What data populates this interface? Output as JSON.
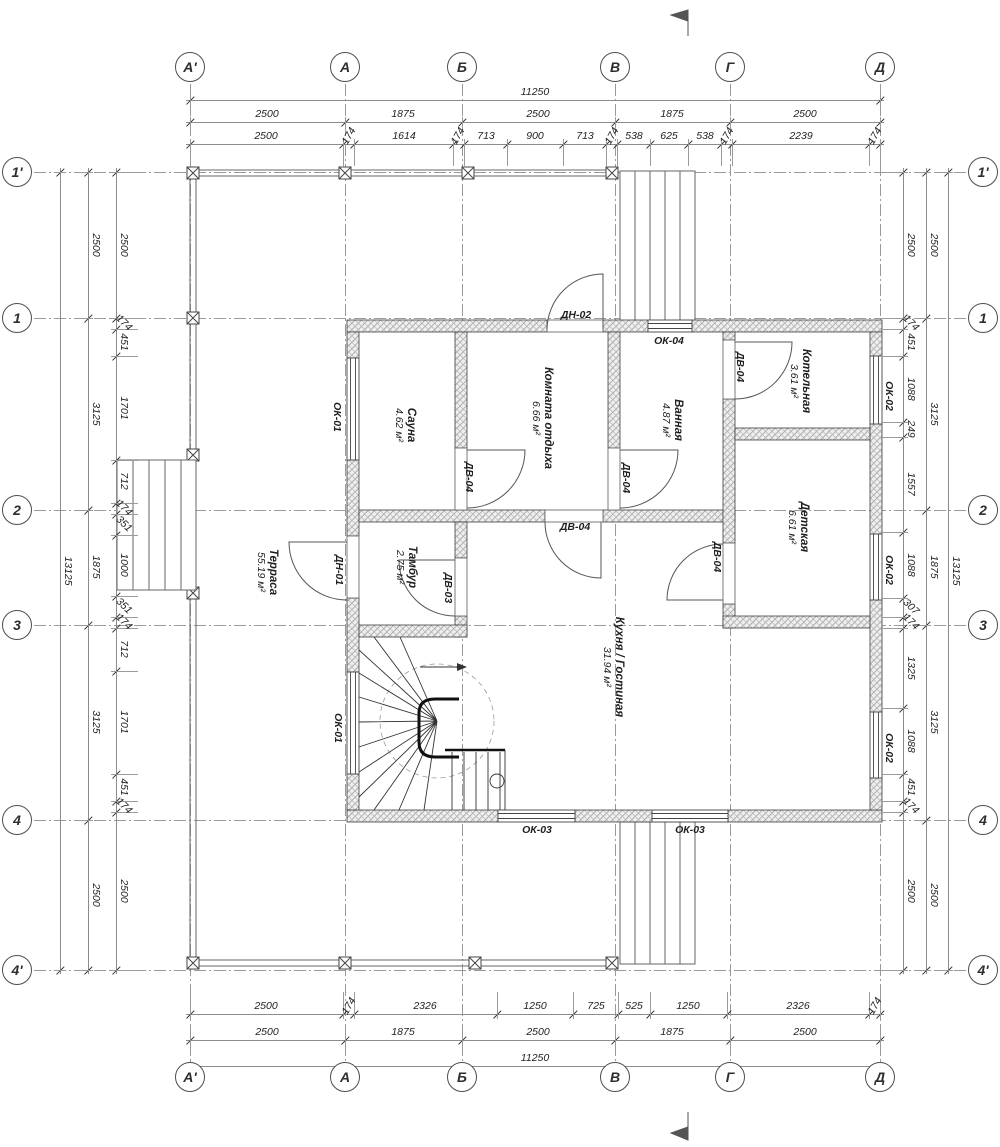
{
  "drawing": {
    "type": "floor-plan",
    "units": "mm",
    "total_width": "11250",
    "total_height": "13125",
    "line_color": "#3d3d3d",
    "hatch_color": "#8a8a8a"
  },
  "axes": {
    "vertical": [
      {
        "label": "А'",
        "x": 190
      },
      {
        "label": "А",
        "x": 345
      },
      {
        "label": "Б",
        "x": 462
      },
      {
        "label": "В",
        "x": 615
      },
      {
        "label": "Г",
        "x": 730
      },
      {
        "label": "Д",
        "x": 880
      }
    ],
    "horizontal": [
      {
        "label": "1'",
        "y": 172
      },
      {
        "label": "1",
        "y": 318
      },
      {
        "label": "2",
        "y": 510
      },
      {
        "label": "3",
        "y": 625
      },
      {
        "label": "4",
        "y": 820
      },
      {
        "label": "4'",
        "y": 970
      }
    ]
  },
  "dim_rows": [
    {
      "id": "top-total",
      "o": "h",
      "pos": 100,
      "from": 190,
      "to": 880,
      "ticks": [
        190,
        880
      ],
      "labels": [
        {
          "t": "11250",
          "c": 535
        }
      ]
    },
    {
      "id": "top-grid",
      "o": "h",
      "pos": 122,
      "from": 190,
      "to": 880,
      "ticks": [
        190,
        345,
        462,
        615,
        730,
        880
      ],
      "labels": [
        {
          "t": "2500",
          "c": 267
        },
        {
          "t": "1875",
          "c": 403
        },
        {
          "t": "2500",
          "c": 538
        },
        {
          "t": "1875",
          "c": 672
        },
        {
          "t": "2500",
          "c": 805
        }
      ]
    },
    {
      "id": "top-detail",
      "o": "h",
      "pos": 144,
      "from": 190,
      "to": 880,
      "ext": true,
      "extdir": 1,
      "ticks": [
        190,
        343,
        354,
        453,
        464,
        507,
        563,
        606,
        617,
        650,
        688,
        721,
        732,
        869,
        880
      ],
      "labels": [
        {
          "t": "2500",
          "c": 266
        },
        {
          "t": "174",
          "c": 349,
          "r": 1
        },
        {
          "t": "1614",
          "c": 404
        },
        {
          "t": "174",
          "c": 458,
          "r": 1
        },
        {
          "t": "713",
          "c": 486
        },
        {
          "t": "900",
          "c": 535
        },
        {
          "t": "713",
          "c": 585
        },
        {
          "t": "174",
          "c": 612,
          "r": 1
        },
        {
          "t": "538",
          "c": 634
        },
        {
          "t": "625",
          "c": 669
        },
        {
          "t": "538",
          "c": 705
        },
        {
          "t": "174",
          "c": 727,
          "r": 1
        },
        {
          "t": "2239",
          "c": 801
        },
        {
          "t": "174",
          "c": 875,
          "r": 1
        }
      ]
    },
    {
      "id": "bottom-detail",
      "o": "h",
      "pos": 1014,
      "from": 190,
      "to": 880,
      "ext": true,
      "extdir": -1,
      "ticks": [
        190,
        343,
        354,
        497,
        573,
        618,
        650,
        727,
        869,
        880
      ],
      "labels": [
        {
          "t": "2500",
          "c": 266
        },
        {
          "t": "174",
          "c": 349,
          "r": 1
        },
        {
          "t": "2326",
          "c": 425
        },
        {
          "t": "1250",
          "c": 535
        },
        {
          "t": "725",
          "c": 596
        },
        {
          "t": "525",
          "c": 634
        },
        {
          "t": "1250",
          "c": 688
        },
        {
          "t": "2326",
          "c": 798
        },
        {
          "t": "174",
          "c": 875,
          "r": 1
        }
      ]
    },
    {
      "id": "bottom-grid",
      "o": "h",
      "pos": 1040,
      "from": 190,
      "to": 880,
      "ticks": [
        190,
        345,
        462,
        615,
        730,
        880
      ],
      "labels": [
        {
          "t": "2500",
          "c": 267
        },
        {
          "t": "1875",
          "c": 403
        },
        {
          "t": "2500",
          "c": 538
        },
        {
          "t": "1875",
          "c": 672
        },
        {
          "t": "2500",
          "c": 805
        }
      ]
    },
    {
      "id": "bottom-total",
      "o": "h",
      "pos": 1066,
      "from": 190,
      "to": 880,
      "ticks": [
        190,
        880
      ],
      "labels": [
        {
          "t": "11250",
          "c": 535
        }
      ]
    },
    {
      "id": "left-total",
      "o": "v",
      "pos": 60,
      "from": 172,
      "to": 970,
      "ticks": [
        172,
        970
      ],
      "labels": [
        {
          "t": "13125",
          "c": 571
        }
      ]
    },
    {
      "id": "left-grid",
      "o": "v",
      "pos": 88,
      "from": 172,
      "to": 970,
      "ticks": [
        172,
        318,
        510,
        625,
        820,
        970
      ],
      "labels": [
        {
          "t": "2500",
          "c": 245
        },
        {
          "t": "3125",
          "c": 414
        },
        {
          "t": "1875",
          "c": 567
        },
        {
          "t": "3125",
          "c": 722
        },
        {
          "t": "2500",
          "c": 895
        }
      ]
    },
    {
      "id": "left-detail",
      "o": "v",
      "pos": 116,
      "from": 172,
      "to": 970,
      "ext": true,
      "extdir": 1,
      "ticks": [
        172,
        318,
        329,
        356,
        460,
        503,
        514,
        535,
        596,
        617,
        628,
        671,
        774,
        801,
        812,
        970
      ],
      "labels": [
        {
          "t": "2500",
          "c": 245
        },
        {
          "t": "174",
          "c": 323,
          "r": 1
        },
        {
          "t": "451",
          "c": 342
        },
        {
          "t": "1701",
          "c": 408
        },
        {
          "t": "712",
          "c": 481
        },
        {
          "t": "174",
          "c": 508,
          "r": 1
        },
        {
          "t": "351",
          "c": 524,
          "r": 1
        },
        {
          "t": "1000",
          "c": 565
        },
        {
          "t": "351",
          "c": 606,
          "r": 1
        },
        {
          "t": "174",
          "c": 622,
          "r": 1
        },
        {
          "t": "712",
          "c": 649
        },
        {
          "t": "1701",
          "c": 722
        },
        {
          "t": "451",
          "c": 787
        },
        {
          "t": "174",
          "c": 806,
          "r": 1
        },
        {
          "t": "2500",
          "c": 891
        }
      ]
    },
    {
      "id": "right-detail",
      "o": "v",
      "pos": 903,
      "from": 172,
      "to": 970,
      "ext": true,
      "extdir": -1,
      "ticks": [
        172,
        318,
        329,
        356,
        422,
        437,
        532,
        598,
        617,
        628,
        708,
        774,
        801,
        812,
        970
      ],
      "labels": [
        {
          "t": "2500",
          "c": 245
        },
        {
          "t": "174",
          "c": 323,
          "r": 1
        },
        {
          "t": "451",
          "c": 342
        },
        {
          "t": "1088",
          "c": 389
        },
        {
          "t": "249",
          "c": 429
        },
        {
          "t": "1557",
          "c": 484
        },
        {
          "t": "1088",
          "c": 565
        },
        {
          "t": "307",
          "c": 607,
          "r": 1
        },
        {
          "t": "174",
          "c": 622,
          "r": 1
        },
        {
          "t": "1325",
          "c": 668
        },
        {
          "t": "1088",
          "c": 741
        },
        {
          "t": "451",
          "c": 787
        },
        {
          "t": "174",
          "c": 806,
          "r": 1
        },
        {
          "t": "2500",
          "c": 891
        }
      ]
    },
    {
      "id": "right-grid",
      "o": "v",
      "pos": 926,
      "from": 172,
      "to": 970,
      "ticks": [
        172,
        318,
        510,
        625,
        820,
        970
      ],
      "labels": [
        {
          "t": "2500",
          "c": 245
        },
        {
          "t": "3125",
          "c": 414
        },
        {
          "t": "1875",
          "c": 567
        },
        {
          "t": "3125",
          "c": 722
        },
        {
          "t": "2500",
          "c": 895
        }
      ]
    },
    {
      "id": "right-total",
      "o": "v",
      "pos": 948,
      "from": 172,
      "to": 970,
      "ticks": [
        172,
        970
      ],
      "labels": [
        {
          "t": "13125",
          "c": 571
        }
      ]
    }
  ],
  "rooms": [
    {
      "name": "Сауна",
      "area": "4.62 м²",
      "x": 405,
      "y": 425,
      "rot": true
    },
    {
      "name": "Комната отдыха",
      "area": "6.66 м²",
      "x": 542,
      "y": 418,
      "rot": true
    },
    {
      "name": "Ванная",
      "area": "4.87 м²",
      "x": 672,
      "y": 420,
      "rot": true
    },
    {
      "name": "Котельная",
      "area": "3.61 м²",
      "x": 800,
      "y": 381,
      "rot": true
    },
    {
      "name": "Детская",
      "area": "6.61 м²",
      "x": 798,
      "y": 527,
      "rot": true
    },
    {
      "name": "Кухня / Гостиная",
      "area": "31.94 м²",
      "x": 613,
      "y": 667,
      "rot": true
    },
    {
      "name": "Тамбур",
      "area": "2.75 м²",
      "x": 406,
      "y": 567,
      "rot": true
    },
    {
      "name": "Терраса",
      "area": "55.19 м²",
      "x": 267,
      "y": 572,
      "rot": true
    }
  ],
  "opening_tags": [
    {
      "t": "ДН-02",
      "x": 576,
      "y": 315,
      "rot": false
    },
    {
      "t": "ОК-04",
      "x": 669,
      "y": 341,
      "rot": false
    },
    {
      "t": "ДВ-04",
      "x": 469,
      "y": 477,
      "rot": true
    },
    {
      "t": "ДВ-04",
      "x": 626,
      "y": 478,
      "rot": true
    },
    {
      "t": "ДВ-04",
      "x": 740,
      "y": 367,
      "rot": true
    },
    {
      "t": "ДВ-04",
      "x": 575,
      "y": 527,
      "rot": false
    },
    {
      "t": "ДВ-04",
      "x": 717,
      "y": 557,
      "rot": true
    },
    {
      "t": "ДВ-03",
      "x": 448,
      "y": 588,
      "rot": true
    },
    {
      "t": "ДН-01",
      "x": 339,
      "y": 570,
      "rot": true
    },
    {
      "t": "ОК-01",
      "x": 337,
      "y": 417,
      "rot": true
    },
    {
      "t": "ОК-01",
      "x": 338,
      "y": 728,
      "rot": true
    },
    {
      "t": "ОК-02",
      "x": 889,
      "y": 396,
      "rot": true
    },
    {
      "t": "ОК-02",
      "x": 889,
      "y": 570,
      "rot": true
    },
    {
      "t": "ОК-02",
      "x": 889,
      "y": 748,
      "rot": true
    },
    {
      "t": "ОК-03",
      "x": 537,
      "y": 830,
      "rot": false
    },
    {
      "t": "ОК-03",
      "x": 690,
      "y": 830,
      "rot": false
    }
  ]
}
